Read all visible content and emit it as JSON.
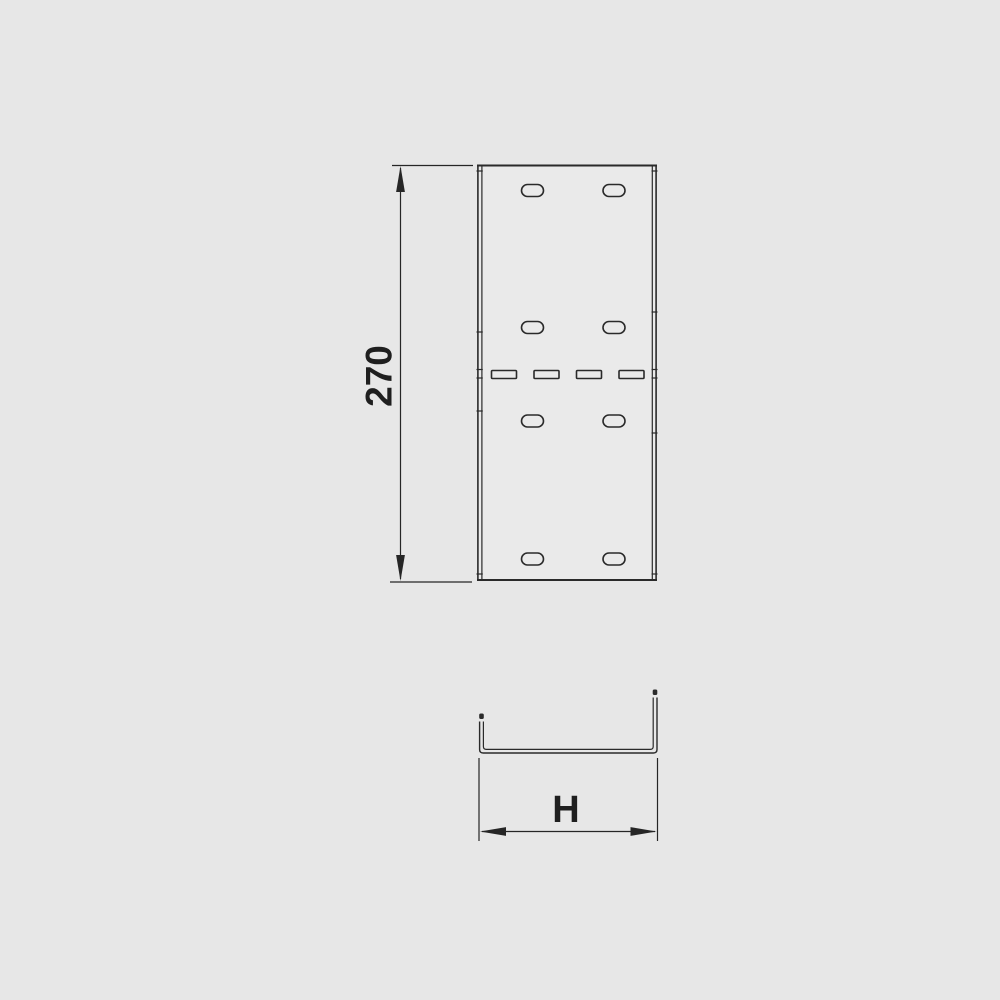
{
  "page": {
    "background_color": "#e7e7e7"
  },
  "drawing": {
    "kind": "technical-drawing",
    "colors": {
      "line": "#2a2a2a",
      "text": "#1f1f1f",
      "plate_fill": "#eaeaea"
    },
    "plan_view": {
      "name": "tray-section-top-view",
      "oval_hole_rows": 4,
      "oval_holes_per_row": 2,
      "center_slot_count": 4
    },
    "profile_view": {
      "name": "u-channel-cross-section"
    },
    "dimensions": {
      "length_label": "270",
      "width_label": "H"
    }
  }
}
